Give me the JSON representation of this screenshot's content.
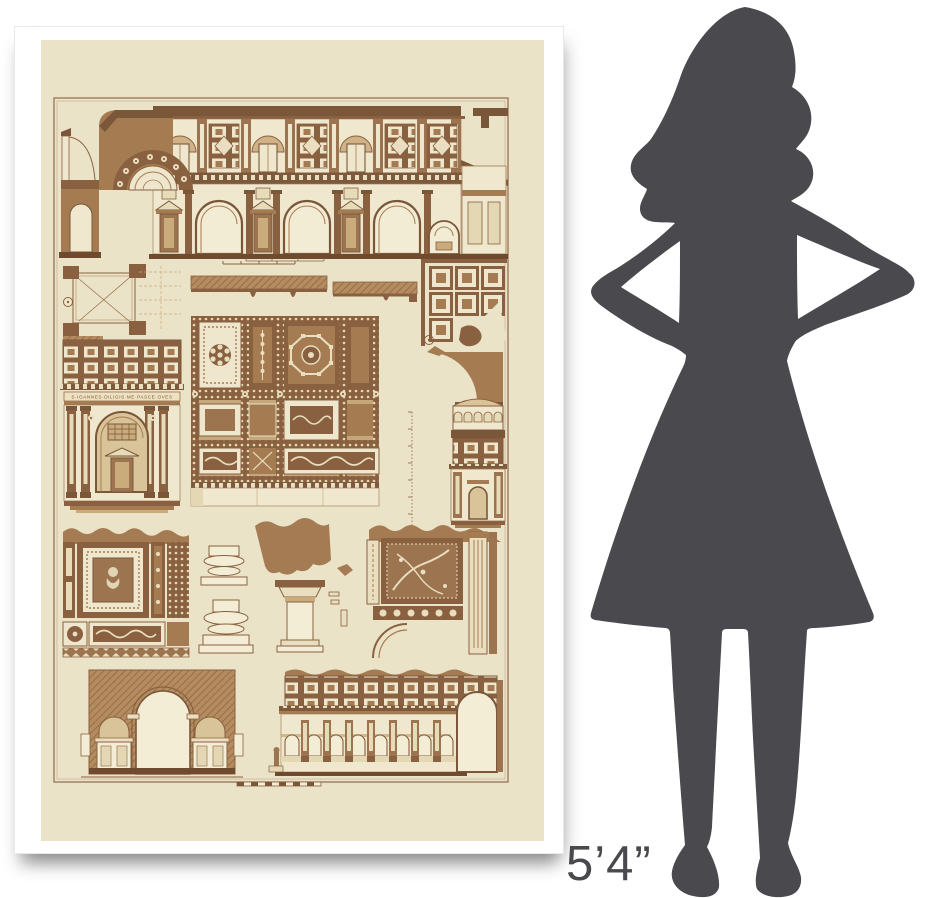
{
  "scale_reference": {
    "height_label": "5’4”",
    "silhouette": "woman-hands-on-hips-silhouette",
    "silhouette_color": "#4a494d"
  },
  "poster": {
    "frame_color": "#ffffff",
    "paper_color": "#ebe3c8",
    "ink_color": "#7b573a",
    "frieze_inscription": "S·IOANNES·DILIGIS·ME·PASCE·OVES",
    "panels": [
      "nave-section-elevation",
      "aisle-section-fragment",
      "coffered-arch",
      "pier-plan",
      "ceiling-section-profile",
      "coffered-ceiling-plan",
      "altar-aedicule-elevation",
      "ornate-ceiling-coffer-panel",
      "niche-section-with-scale",
      "ceiling-coffer-detail",
      "column-base-profiles",
      "capital-fragment",
      "ceiling-corner-ornament",
      "chapel-arches-section",
      "arcade-elevation"
    ]
  }
}
